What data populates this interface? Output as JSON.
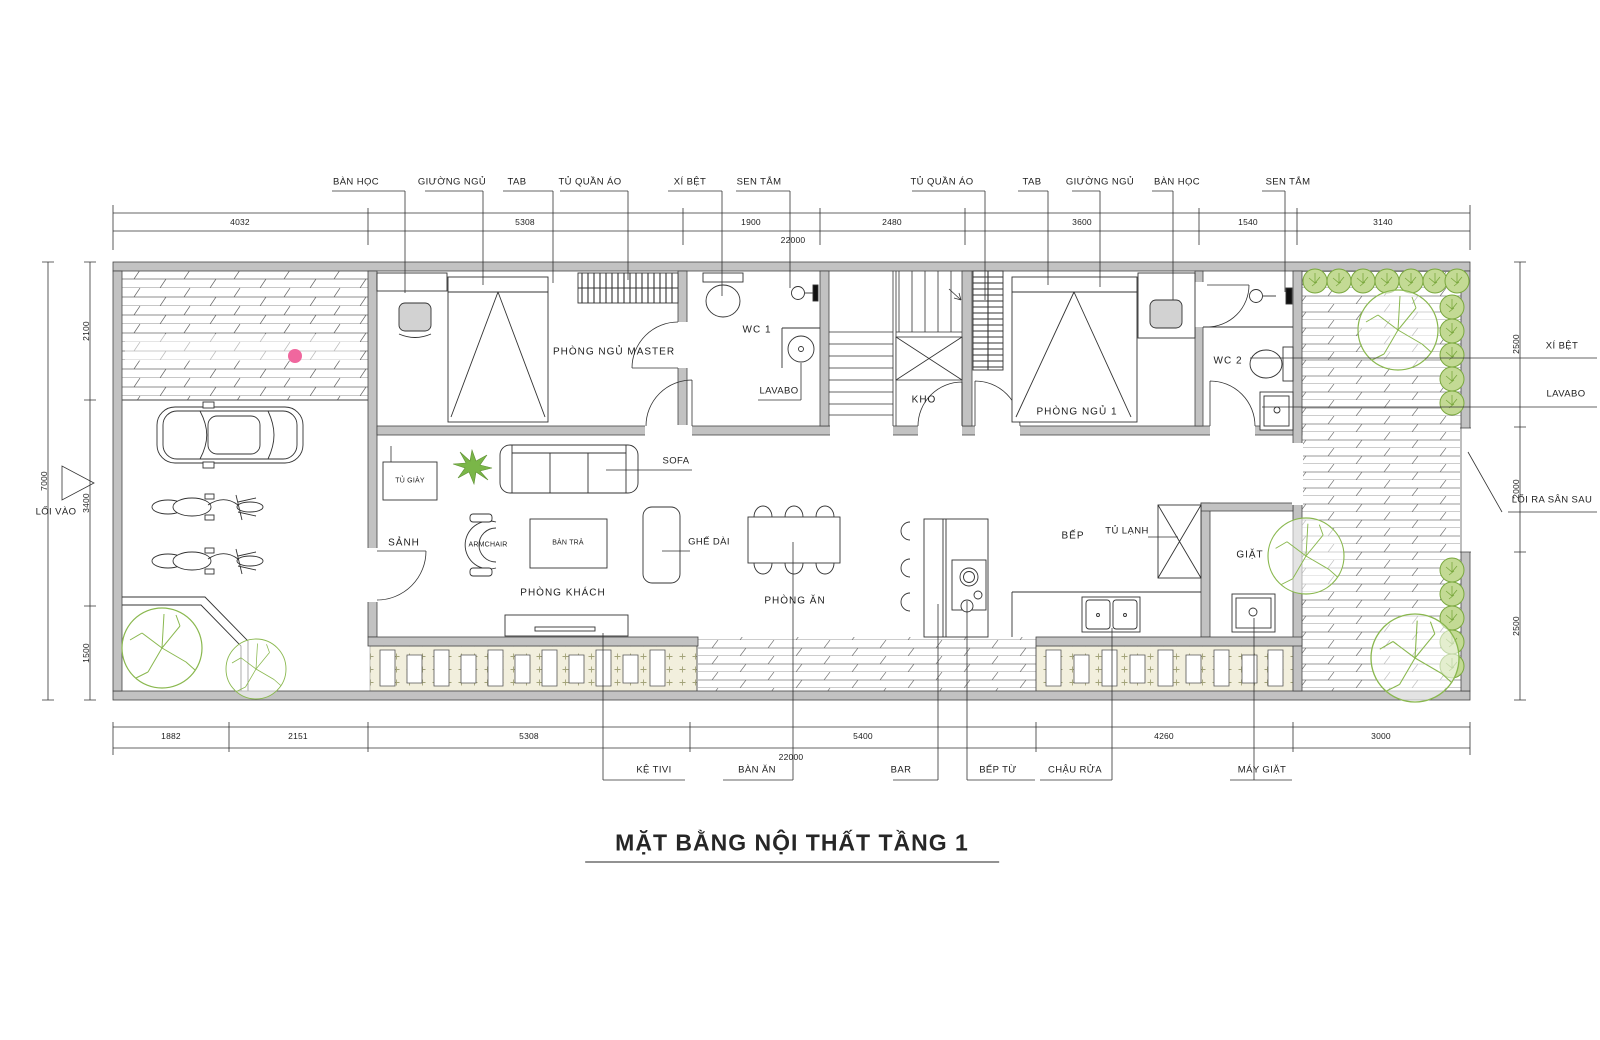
{
  "title": "MẶT BẰNG NỘI THẤT TẦNG 1",
  "callouts": {
    "top": [
      "BÀN HỌC",
      "GIƯỜNG NGỦ",
      "TAB",
      "TỦ QUẦN ÁO",
      "XÍ BỆT",
      "SEN TẮM",
      "TỦ QUẦN ÁO",
      "TAB",
      "GIƯỜNG NGỦ",
      "BÀN HỌC",
      "SEN TẮM"
    ],
    "bottom": [
      "KỆ TIVI",
      "BÀN ĂN",
      "BAR",
      "BẾP TỪ",
      "CHẬU RỬA",
      "MÁY GIẶT"
    ],
    "right": [
      "XÍ BỆT",
      "LAVABO",
      "LỐI RA SÂN SAU"
    ],
    "left": [
      "LỐI VÀO"
    ]
  },
  "rooms": {
    "master": "PHÒNG NGỦ MASTER",
    "wc1": "WC 1",
    "lavabo": "LAVABO",
    "kho": "KHO",
    "bedroom1": "PHÒNG NGỦ 1",
    "wc2": "WC 2",
    "sanh": "SẢNH",
    "shoe_cabinet": "TỦ GIÀY",
    "armchair": "ARMCHAIR",
    "coffee_table": "BÀN TRÀ",
    "sofa": "SOFA",
    "bench": "GHẾ DÀI",
    "living": "PHÒNG KHÁCH",
    "dining": "PHÒNG ĂN",
    "kitchen": "BẾP",
    "fridge": "TỦ LẠNH",
    "laundry": "GIẶT"
  },
  "dims": {
    "top": [
      "4032",
      "5308",
      "1900",
      "2480",
      "3600",
      "1540",
      "3140"
    ],
    "top_total": "22000",
    "bottom": [
      "1882",
      "2151",
      "5308",
      "5400",
      "4260",
      "3000"
    ],
    "bottom_total": "22000",
    "left": [
      "2100",
      "3400",
      "1500"
    ],
    "left_total": "7000",
    "right": [
      "2500",
      "2000",
      "2500"
    ]
  },
  "colors": {
    "wall": "#c2c2c2",
    "line": "#333333",
    "tree_green": "#8ab84f",
    "pebble_bg": "#f2efdd",
    "watermark_pink": "#f0679e"
  }
}
